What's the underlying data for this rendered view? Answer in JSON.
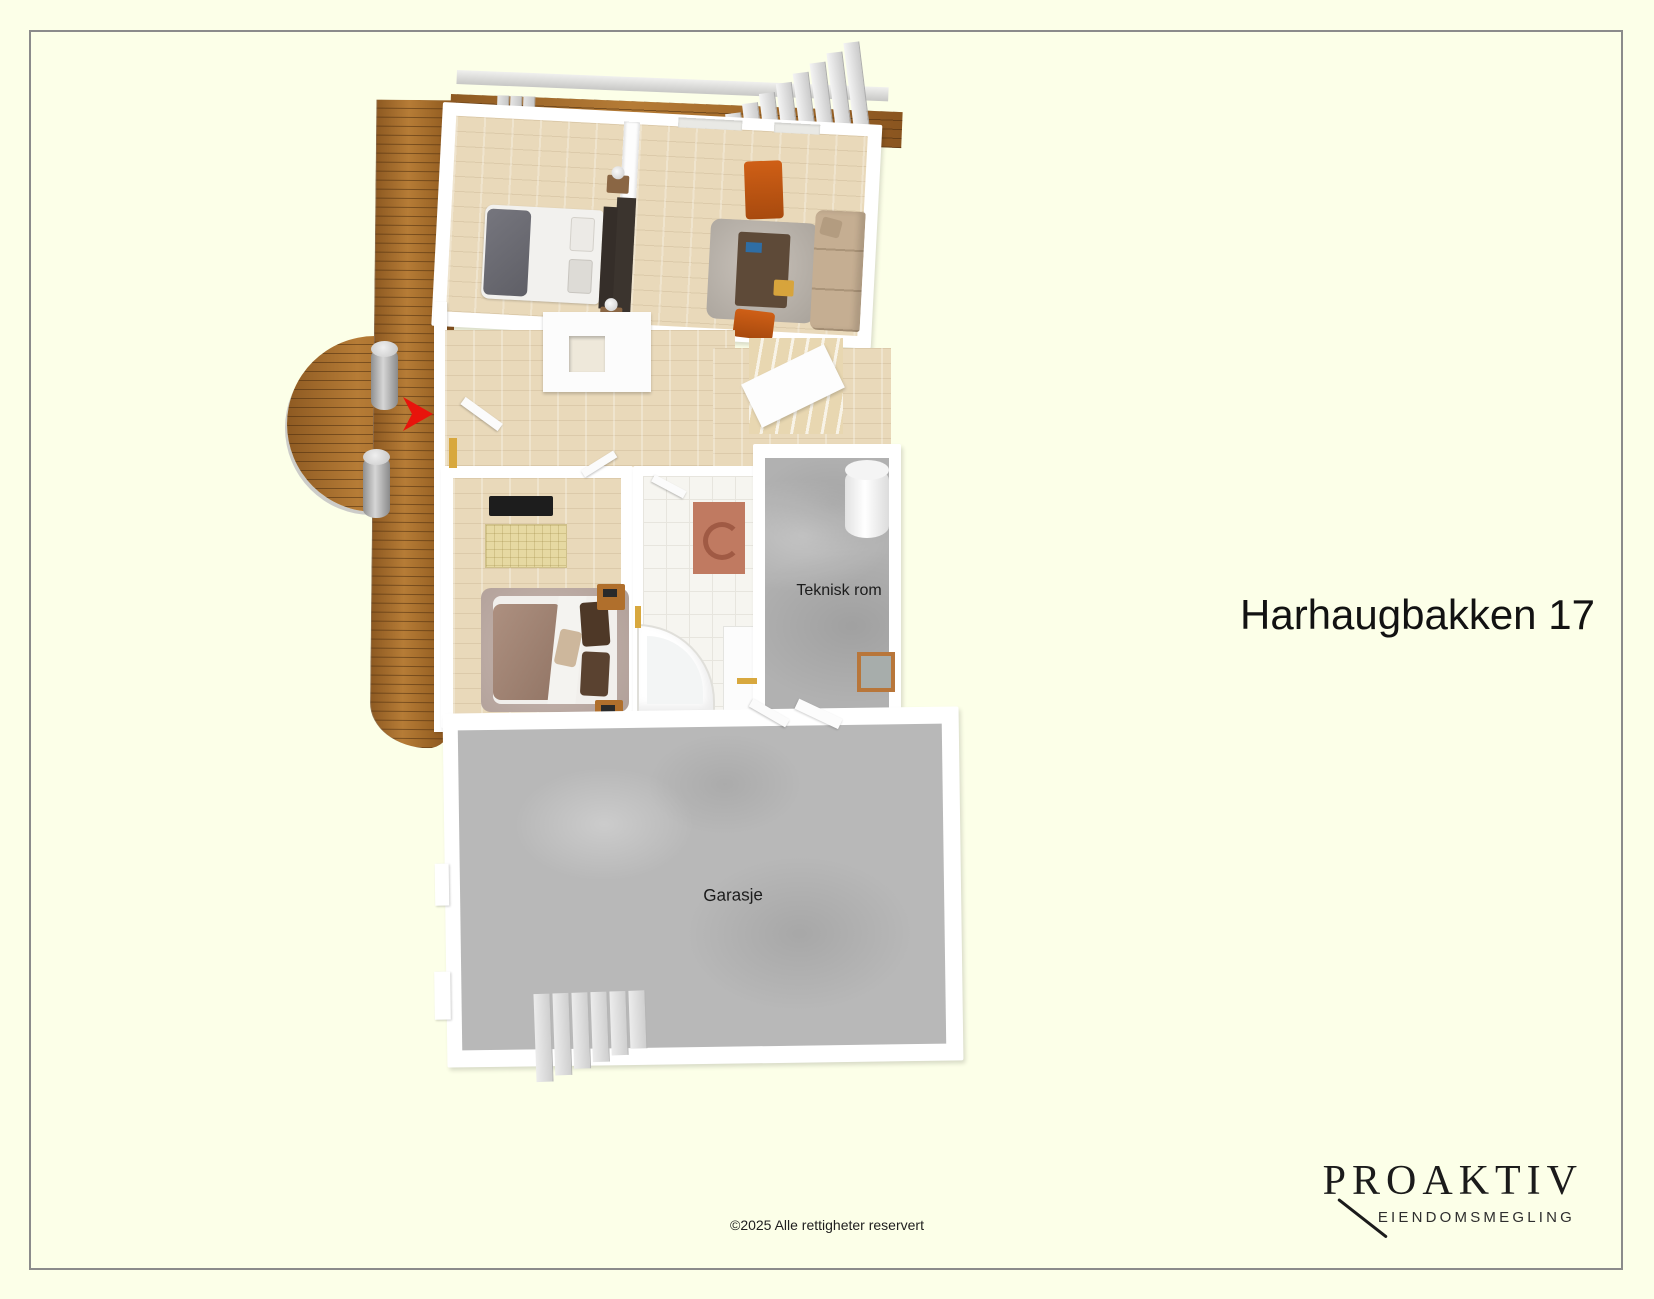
{
  "page": {
    "background_color": "#FCFFE8",
    "frame_border_color": "#8B8B8B"
  },
  "title": "Harhaugbakken 17",
  "floorplan": {
    "room_labels": {
      "technical_room": "Teknisk rom",
      "garage": "Garasje"
    },
    "colors": {
      "deck_wood": "#A56A2B",
      "interior_floor": "#E9D9BA",
      "concrete_floor": "#B8B8B8",
      "walls": "#FFFFFF",
      "entrance_arrow": "#E8140C"
    }
  },
  "footer": {
    "copyright": "©2025 Alle rettigheter reservert"
  },
  "logo": {
    "brand": "PROAKTIV",
    "tagline": "EIENDOMSMEGLING"
  }
}
